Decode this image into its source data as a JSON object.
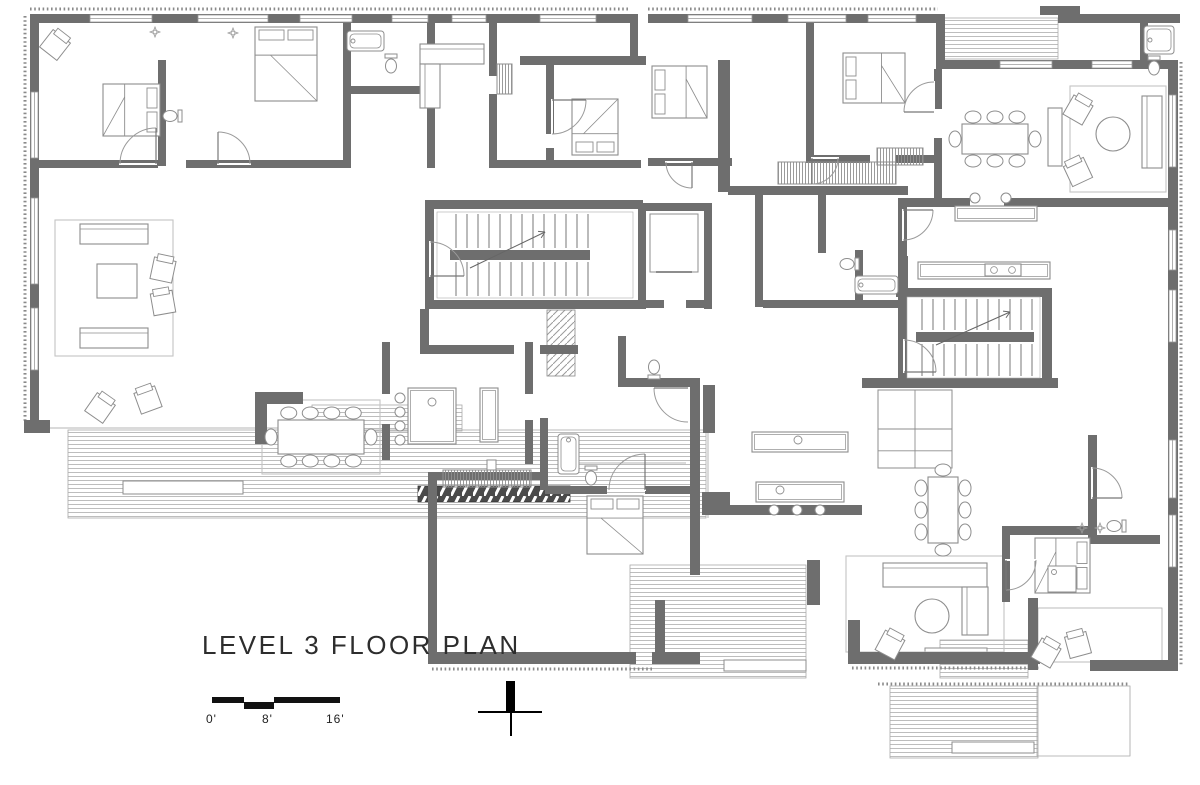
{
  "meta": {
    "title": "LEVEL 3 FLOOR PLAN"
  },
  "scale_bar": {
    "labels": [
      "0'",
      "8'",
      "16'"
    ],
    "segments": [
      [
        212,
        697,
        32,
        6
      ],
      [
        244,
        702,
        30,
        7
      ],
      [
        274,
        697,
        66,
        6
      ]
    ],
    "label_pos": [
      [
        206,
        712
      ],
      [
        262,
        712
      ],
      [
        326,
        712
      ]
    ]
  },
  "north_arrow": {
    "present": true
  },
  "colors": {
    "wall": "#6e6e6e",
    "wallDark": "#5e5e5e",
    "furn": "#8d8d8d",
    "thin": "#b5b5b5",
    "deckStripe": "#bdbdbd",
    "deckEdge": "#aaaaaa",
    "door": "#9a9a9a",
    "rug": "#c4c4c4",
    "stair": "#777777",
    "tick": "#8a8a8a",
    "fire": "#4a4a4a",
    "text": "#2d2d2d"
  },
  "floorplan": {
    "walls": [
      [
        30,
        14,
        600,
        9
      ],
      [
        648,
        14,
        292,
        9
      ],
      [
        936,
        14,
        9,
        55
      ],
      [
        940,
        60,
        236,
        9
      ],
      [
        1058,
        14,
        122,
        9
      ],
      [
        1168,
        60,
        10,
        610
      ],
      [
        30,
        14,
        9,
        412
      ],
      [
        24,
        420,
        26,
        13
      ],
      [
        1040,
        6,
        40,
        9
      ],
      [
        1140,
        16,
        8,
        50
      ],
      [
        158,
        60,
        8,
        106
      ],
      [
        38,
        160,
        120,
        8
      ],
      [
        186,
        160,
        162,
        8
      ],
      [
        343,
        14,
        8,
        154
      ],
      [
        427,
        14,
        8,
        78
      ],
      [
        427,
        108,
        8,
        60
      ],
      [
        345,
        86,
        84,
        8
      ],
      [
        489,
        14,
        8,
        62
      ],
      [
        489,
        94,
        8,
        74
      ],
      [
        489,
        160,
        152,
        8
      ],
      [
        546,
        60,
        8,
        74
      ],
      [
        546,
        148,
        8,
        20
      ],
      [
        520,
        56,
        126,
        9
      ],
      [
        630,
        14,
        8,
        48
      ],
      [
        718,
        60,
        12,
        132
      ],
      [
        648,
        158,
        84,
        8
      ],
      [
        728,
        186,
        180,
        9
      ],
      [
        806,
        22,
        8,
        140
      ],
      [
        806,
        155,
        64,
        8
      ],
      [
        896,
        155,
        44,
        8
      ],
      [
        934,
        69,
        8,
        40
      ],
      [
        934,
        138,
        8,
        64
      ],
      [
        898,
        198,
        72,
        9
      ],
      [
        1004,
        198,
        164,
        9
      ],
      [
        898,
        198,
        9,
        98
      ],
      [
        755,
        195,
        8,
        112
      ],
      [
        763,
        300,
        140,
        8
      ],
      [
        818,
        195,
        8,
        58
      ],
      [
        855,
        250,
        8,
        58
      ],
      [
        898,
        256,
        10,
        132
      ],
      [
        425,
        200,
        218,
        9
      ],
      [
        425,
        209,
        9,
        95
      ],
      [
        425,
        300,
        218,
        9
      ],
      [
        638,
        203,
        8,
        106
      ],
      [
        704,
        203,
        8,
        106
      ],
      [
        638,
        203,
        70,
        8
      ],
      [
        638,
        300,
        26,
        8
      ],
      [
        686,
        300,
        26,
        8
      ],
      [
        896,
        288,
        156,
        9
      ],
      [
        1042,
        288,
        10,
        100
      ],
      [
        862,
        378,
        196,
        10
      ],
      [
        420,
        309,
        9,
        40
      ],
      [
        420,
        345,
        94,
        9
      ],
      [
        540,
        345,
        38,
        9
      ],
      [
        382,
        342,
        8,
        52
      ],
      [
        382,
        424,
        8,
        36
      ],
      [
        525,
        342,
        8,
        52
      ],
      [
        525,
        420,
        8,
        44
      ],
      [
        618,
        336,
        8,
        48
      ],
      [
        618,
        378,
        82,
        9
      ],
      [
        690,
        380,
        10,
        195
      ],
      [
        428,
        472,
        112,
        8
      ],
      [
        428,
        478,
        9,
        186
      ],
      [
        428,
        652,
        208,
        12
      ],
      [
        655,
        600,
        10,
        64
      ],
      [
        652,
        652,
        48,
        12
      ],
      [
        540,
        418,
        8,
        72
      ],
      [
        545,
        486,
        62,
        8
      ],
      [
        645,
        486,
        48,
        8
      ],
      [
        255,
        392,
        48,
        12
      ],
      [
        255,
        392,
        12,
        52
      ],
      [
        703,
        385,
        12,
        48
      ],
      [
        702,
        492,
        28,
        22
      ],
      [
        702,
        505,
        160,
        10
      ],
      [
        807,
        560,
        13,
        45
      ],
      [
        848,
        620,
        12,
        44
      ],
      [
        848,
        652,
        192,
        12
      ],
      [
        1028,
        598,
        10,
        72
      ],
      [
        1090,
        660,
        88,
        11
      ],
      [
        1002,
        526,
        90,
        9
      ],
      [
        1002,
        528,
        8,
        74
      ],
      [
        1088,
        435,
        9,
        102
      ],
      [
        1088,
        535,
        72,
        9
      ]
    ],
    "decks_striped": [
      [
        68,
        430,
        638,
        88
      ],
      [
        312,
        405,
        150,
        26
      ],
      [
        630,
        565,
        176,
        113
      ],
      [
        890,
        686,
        148,
        72
      ],
      [
        940,
        640,
        88,
        38
      ],
      [
        940,
        18,
        118,
        41
      ]
    ],
    "decks_plain": [
      [
        1037,
        686,
        93,
        70
      ],
      [
        1038,
        608,
        124,
        54
      ]
    ],
    "benches": [
      [
        123,
        481,
        120,
        13
      ],
      [
        724,
        660,
        82,
        11
      ],
      [
        952,
        742,
        82,
        11
      ],
      [
        487,
        460,
        9,
        13
      ],
      [
        925,
        648,
        62,
        12
      ]
    ],
    "fire_feature": [
      418,
      486,
      152,
      16
    ],
    "hatches": [
      [
        547,
        310,
        28,
        66
      ]
    ],
    "wardrobes": [
      [
        778,
        162,
        118,
        22
      ],
      [
        877,
        148,
        46,
        17
      ],
      [
        443,
        470,
        88,
        17
      ],
      [
        497,
        64,
        15,
        30
      ]
    ],
    "grid_closets": [
      [
        878,
        390,
        74,
        78
      ]
    ],
    "windows": [
      [
        90,
        15,
        62,
        7
      ],
      [
        198,
        15,
        70,
        7
      ],
      [
        300,
        15,
        52,
        7
      ],
      [
        392,
        15,
        36,
        7
      ],
      [
        452,
        15,
        34,
        7
      ],
      [
        540,
        15,
        56,
        7
      ],
      [
        688,
        15,
        64,
        7
      ],
      [
        788,
        15,
        58,
        7
      ],
      [
        868,
        15,
        48,
        7
      ],
      [
        31,
        92,
        7,
        66
      ],
      [
        31,
        198,
        7,
        86
      ],
      [
        31,
        308,
        7,
        62
      ],
      [
        1169,
        95,
        7,
        72
      ],
      [
        1169,
        230,
        7,
        40
      ],
      [
        1169,
        290,
        7,
        52
      ],
      [
        1169,
        440,
        7,
        58
      ],
      [
        1169,
        515,
        7,
        52
      ],
      [
        1000,
        61,
        52,
        7
      ],
      [
        1092,
        61,
        40,
        7
      ]
    ],
    "stairs": [
      {
        "inner": [
          437,
          212,
          196,
          86
        ],
        "tx1": 456,
        "tx2": 590,
        "step": 11,
        "rail": [
          450,
          250,
          140,
          10
        ],
        "arrow": [
          470,
          268,
          545,
          232
        ]
      },
      {
        "inner": [
          907,
          297,
          133,
          81
        ],
        "tx1": 922,
        "tx2": 1032,
        "step": 11,
        "rail": [
          916,
          332,
          118,
          10
        ],
        "arrow": [
          936,
          345,
          1010,
          312
        ]
      }
    ],
    "elevator": {
      "car": [
        650,
        214,
        48,
        58
      ]
    },
    "doors": [
      [
        156,
        164,
        36,
        180,
        270
      ],
      [
        218,
        164,
        32,
        0,
        -90
      ],
      [
        552,
        100,
        34,
        90,
        0
      ],
      [
        692,
        162,
        26,
        180,
        90
      ],
      [
        812,
        158,
        26,
        0,
        90
      ],
      [
        934,
        112,
        30,
        270,
        180
      ],
      [
        903,
        210,
        30,
        90,
        0
      ],
      [
        430,
        276,
        34,
        270,
        360
      ],
      [
        904,
        372,
        32,
        270,
        360
      ],
      [
        688,
        388,
        34,
        90,
        180
      ],
      [
        1092,
        498,
        30,
        270,
        360
      ],
      [
        645,
        490,
        36,
        180,
        270
      ],
      [
        1006,
        560,
        30,
        0,
        90
      ]
    ],
    "ticks": [
      [
        30,
        9,
        630,
        9
      ],
      [
        648,
        9,
        938,
        9
      ],
      [
        25,
        16,
        25,
        422
      ],
      [
        1181,
        62,
        1181,
        666
      ],
      [
        432,
        669,
        652,
        669
      ],
      [
        852,
        668,
        1040,
        668
      ],
      [
        878,
        684,
        1128,
        684
      ]
    ],
    "thin_lines": [
      [
        40,
        428,
        312,
        428
      ],
      [
        708,
        430,
        708,
        518
      ],
      [
        1130,
        686,
        1130,
        756
      ],
      [
        562,
        463,
        686,
        463
      ]
    ],
    "rugs": [
      [
        55,
        220,
        118,
        136
      ],
      [
        1070,
        86,
        96,
        106
      ],
      [
        846,
        556,
        158,
        96
      ],
      [
        262,
        400,
        118,
        74
      ]
    ],
    "furniture": [
      {
        "t": "bed",
        "r": [
          103,
          84,
          57,
          52
        ],
        "head": "e"
      },
      {
        "t": "bed",
        "r": [
          255,
          27,
          62,
          74
        ],
        "head": "n"
      },
      {
        "t": "bed",
        "r": [
          572,
          99,
          46,
          56
        ],
        "head": "s"
      },
      {
        "t": "bed",
        "r": [
          652,
          66,
          55,
          52
        ],
        "head": "w"
      },
      {
        "t": "bed",
        "r": [
          843,
          53,
          62,
          50
        ],
        "head": "w"
      },
      {
        "t": "bed",
        "r": [
          587,
          496,
          56,
          58
        ],
        "head": "n"
      },
      {
        "t": "bed",
        "r": [
          1035,
          538,
          55,
          55
        ],
        "head": "e"
      },
      {
        "t": "sofa",
        "r": [
          80,
          224,
          68,
          20
        ]
      },
      {
        "t": "sofa",
        "r": [
          80,
          328,
          68,
          20
        ]
      },
      {
        "t": "sofa",
        "r": [
          1142,
          96,
          20,
          72
        ]
      },
      {
        "t": "sofa",
        "r": [
          883,
          563,
          104,
          24
        ]
      },
      {
        "t": "sofa",
        "r": [
          962,
          587,
          26,
          48
        ]
      },
      {
        "t": "sofa",
        "r": [
          420,
          44,
          64,
          20
        ]
      },
      {
        "t": "sofa",
        "r": [
          420,
          64,
          20,
          44
        ]
      },
      {
        "t": "rect",
        "r": [
          97,
          264,
          40,
          34
        ]
      },
      {
        "t": "rect",
        "r": [
          1048,
          108,
          14,
          58
        ]
      },
      {
        "t": "circle",
        "c": [
          1113,
          134
        ],
        "rad": 17
      },
      {
        "t": "circle",
        "c": [
          932,
          616
        ],
        "rad": 17
      },
      {
        "t": "chaird",
        "c": [
          55,
          45
        ],
        "a": 38
      },
      {
        "t": "chaird",
        "c": [
          163,
          270
        ],
        "a": 12
      },
      {
        "t": "chaird",
        "c": [
          163,
          303
        ],
        "a": -10
      },
      {
        "t": "chaird",
        "c": [
          100,
          408
        ],
        "a": 35
      },
      {
        "t": "chaird",
        "c": [
          148,
          400
        ],
        "a": -20
      },
      {
        "t": "chaird",
        "c": [
          1078,
          110
        ],
        "a": 30
      },
      {
        "t": "chaird",
        "c": [
          1078,
          172
        ],
        "a": -25
      },
      {
        "t": "chaird",
        "c": [
          890,
          645
        ],
        "a": 28
      },
      {
        "t": "chaird",
        "c": [
          1046,
          653
        ],
        "a": 30
      },
      {
        "t": "chaird",
        "c": [
          1078,
          645
        ],
        "a": -15
      },
      {
        "t": "dining",
        "r": [
          278,
          420,
          86,
          34
        ],
        "axis": "h",
        "n": 4
      },
      {
        "t": "dining",
        "r": [
          962,
          124,
          66,
          30
        ],
        "axis": "h",
        "n": 3
      },
      {
        "t": "dining",
        "r": [
          928,
          477,
          30,
          66
        ],
        "axis": "v",
        "n": 3
      },
      {
        "t": "counter",
        "r": [
          408,
          388,
          48,
          56
        ]
      },
      {
        "t": "counter",
        "r": [
          480,
          388,
          18,
          54
        ]
      },
      {
        "t": "counter",
        "r": [
          918,
          262,
          132,
          17
        ]
      },
      {
        "t": "counter",
        "r": [
          955,
          206,
          82,
          15
        ]
      },
      {
        "t": "counter",
        "r": [
          752,
          432,
          96,
          20
        ]
      },
      {
        "t": "counter",
        "r": [
          756,
          482,
          88,
          20
        ]
      },
      {
        "t": "stove",
        "r": [
          985,
          264,
          36,
          12
        ]
      },
      {
        "t": "stool",
        "c": [
          400,
          398
        ]
      },
      {
        "t": "stool",
        "c": [
          400,
          412
        ]
      },
      {
        "t": "stool",
        "c": [
          400,
          426
        ]
      },
      {
        "t": "stool",
        "c": [
          400,
          440
        ]
      },
      {
        "t": "stool",
        "c": [
          975,
          198
        ]
      },
      {
        "t": "stool",
        "c": [
          1006,
          198
        ]
      },
      {
        "t": "stool",
        "c": [
          774,
          510
        ]
      },
      {
        "t": "stool",
        "c": [
          797,
          510
        ]
      },
      {
        "t": "stool",
        "c": [
          820,
          510
        ]
      },
      {
        "t": "sink",
        "c": [
          432,
          402
        ]
      },
      {
        "t": "sink",
        "c": [
          798,
          440
        ]
      },
      {
        "t": "sink",
        "c": [
          780,
          490
        ]
      },
      {
        "t": "tub",
        "r": [
          347,
          31,
          37,
          20
        ]
      },
      {
        "t": "tub",
        "r": [
          1144,
          26,
          30,
          28
        ]
      },
      {
        "t": "tub",
        "r": [
          855,
          276,
          43,
          18
        ]
      },
      {
        "t": "tub",
        "r": [
          558,
          434,
          21,
          40
        ]
      },
      {
        "t": "toilet",
        "c": [
          172,
          116
        ],
        "o": "e"
      },
      {
        "t": "toilet",
        "c": [
          391,
          64
        ],
        "o": "s"
      },
      {
        "t": "toilet",
        "c": [
          1154,
          66
        ],
        "o": "s"
      },
      {
        "t": "toilet",
        "c": [
          849,
          264
        ],
        "o": "e"
      },
      {
        "t": "toilet",
        "c": [
          591,
          476
        ],
        "o": "s"
      },
      {
        "t": "toilet",
        "c": [
          1116,
          526
        ],
        "o": "e"
      },
      {
        "t": "toilet",
        "c": [
          654,
          369
        ],
        "o": "n"
      },
      {
        "t": "shower",
        "r": [
          1048,
          566,
          28,
          26
        ]
      },
      {
        "t": "sparkle",
        "c": [
          155,
          32
        ]
      },
      {
        "t": "sparkle",
        "c": [
          233,
          33
        ]
      },
      {
        "t": "sparkle",
        "c": [
          1082,
          528
        ]
      },
      {
        "t": "sparkle",
        "c": [
          1100,
          528
        ]
      }
    ]
  }
}
